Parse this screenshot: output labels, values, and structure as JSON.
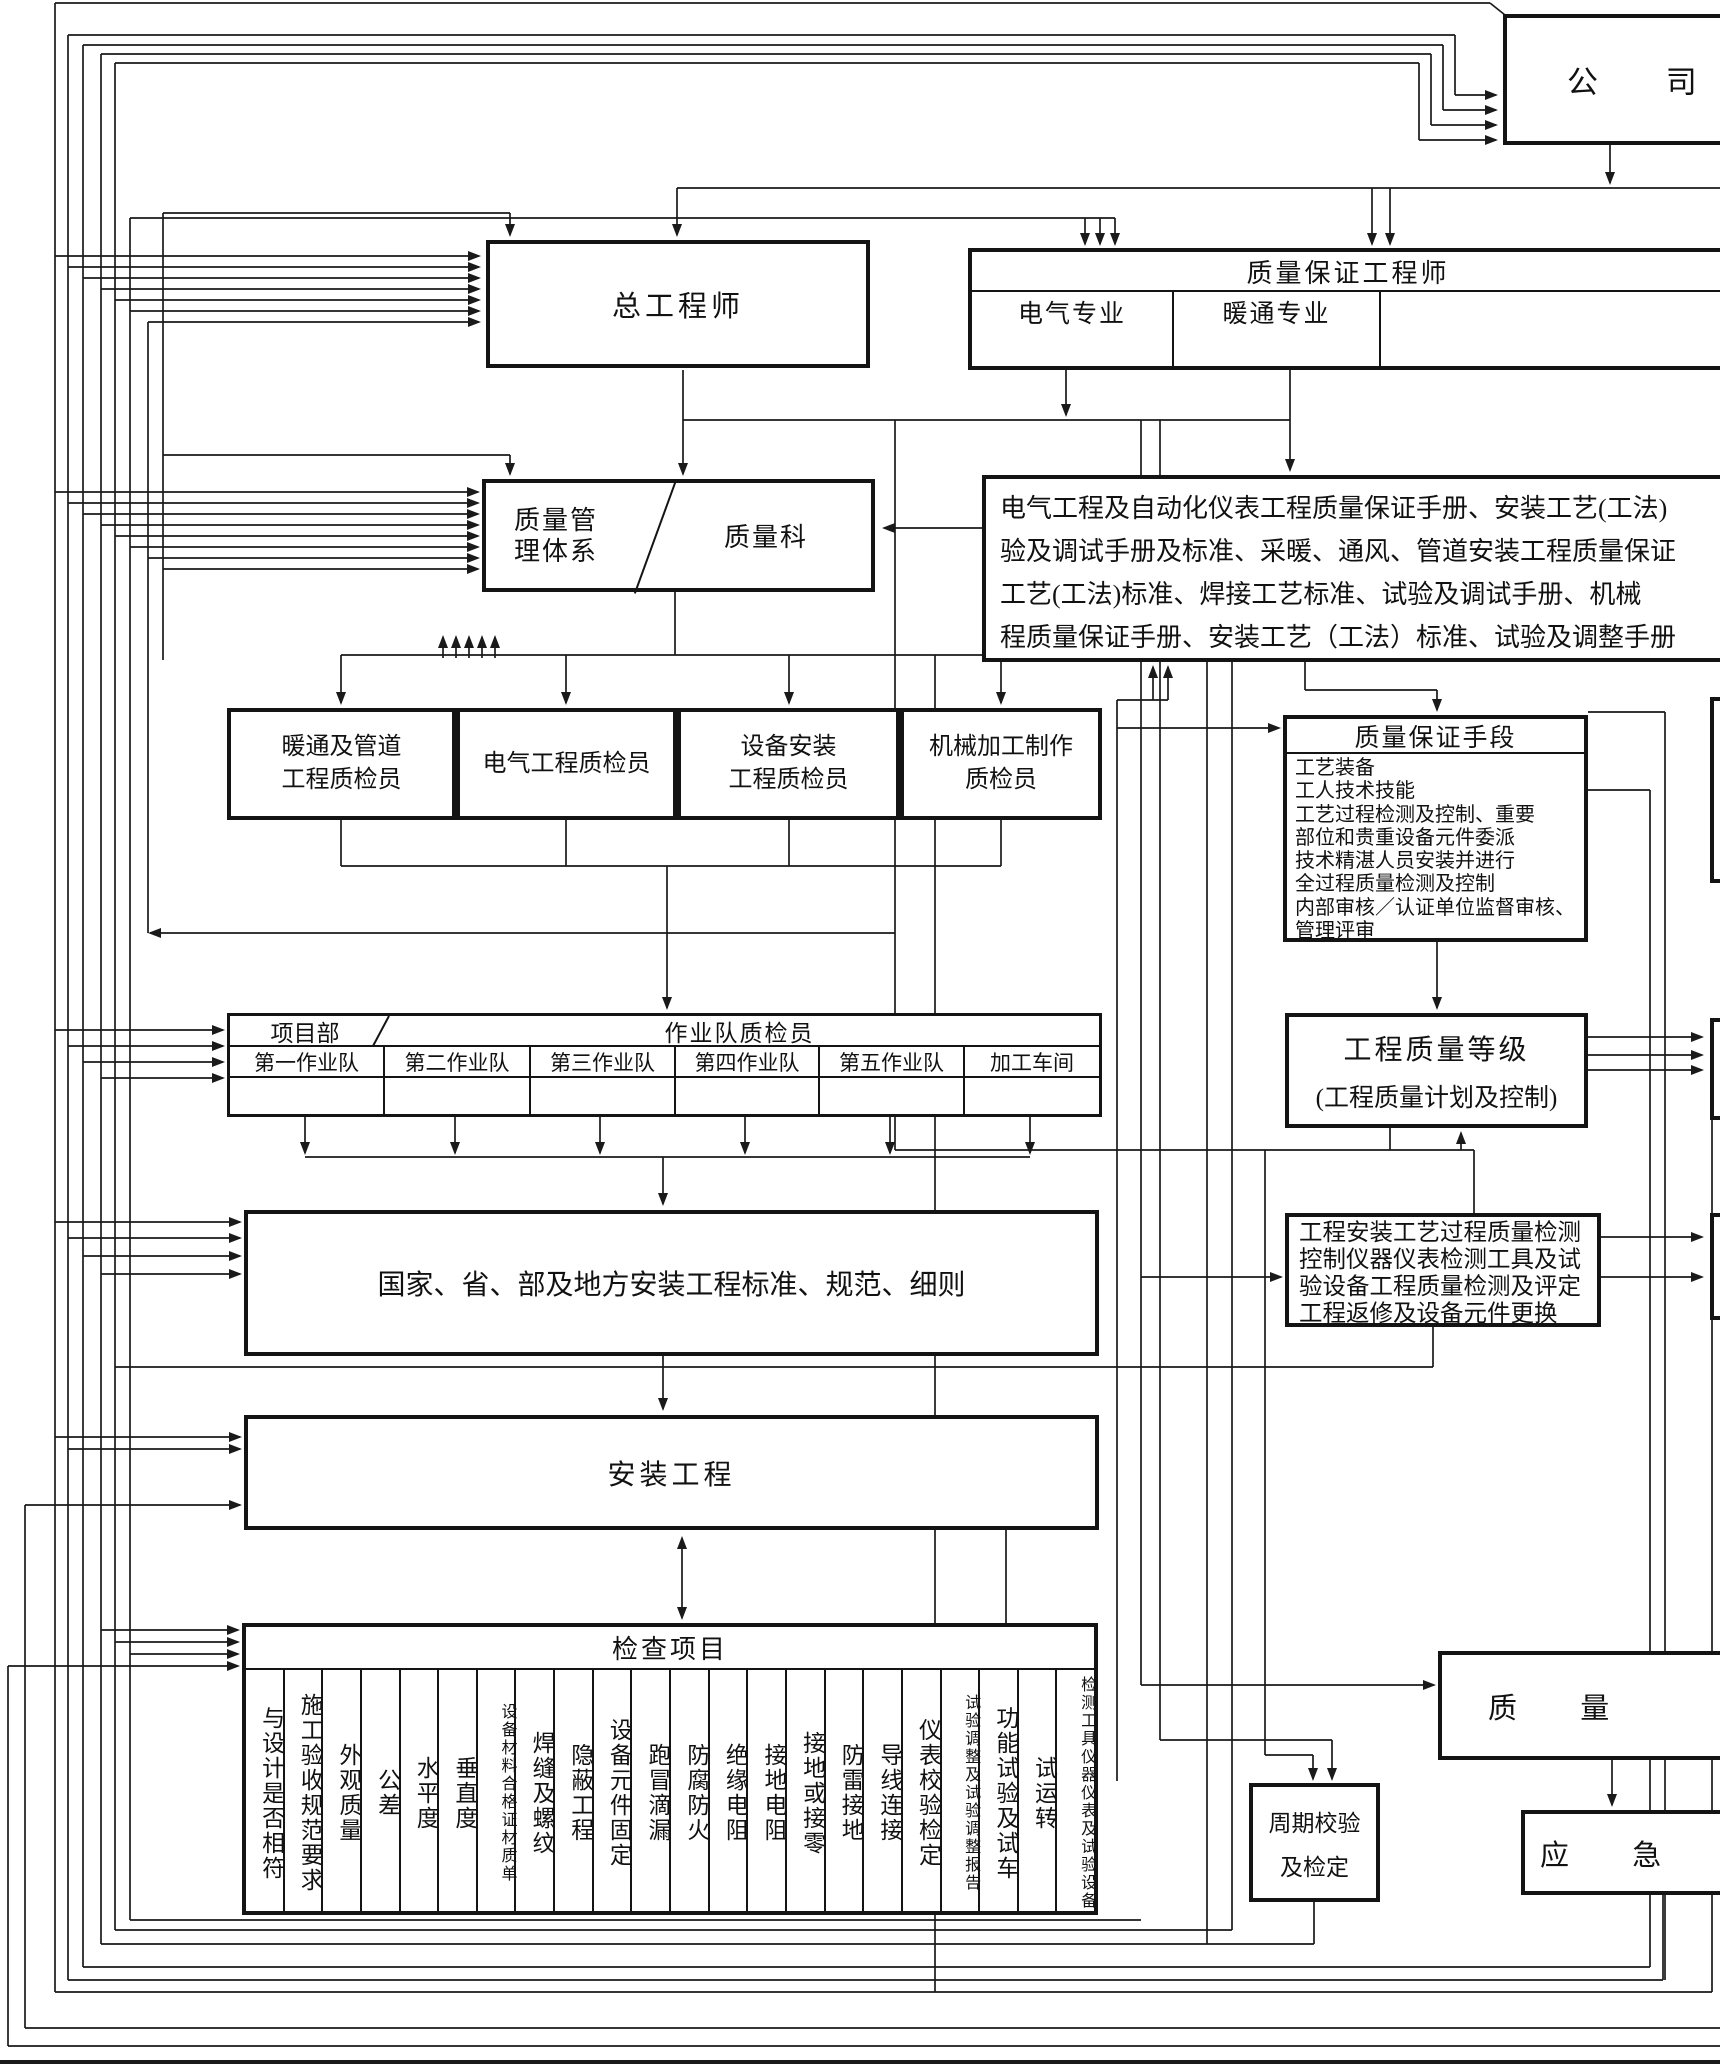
{
  "company": {
    "label": "公 司"
  },
  "chief_engineer": {
    "label": "总工程师"
  },
  "qa_engineer": {
    "title": "质量保证工程师",
    "columns": [
      "电气专业",
      "暖通专业",
      ""
    ]
  },
  "qms": {
    "line1": "质量管",
    "line2": "理体系",
    "dept": "质量科"
  },
  "manuals": {
    "lines": [
      "电气工程及自动化仪表工程质量保证手册、安装工艺(工法)",
      "验及调试手册及标准、采暖、通风、管道安装工程质量保证",
      "工艺(工法)标准、焊接工艺标准、试验及调试手册、机械",
      "程质量保证手册、安装工艺（工法）标准、试验及调整手册"
    ]
  },
  "inspectors": [
    [
      "暖通及管道",
      "工程质检员"
    ],
    [
      "电气工程质检员"
    ],
    [
      "设备安装",
      "工程质检员"
    ],
    [
      "机械加工制作",
      "质检员"
    ]
  ],
  "qa_means": {
    "title": "质量保证手段",
    "items": [
      "工艺装备",
      "工人技术技能",
      "工艺过程检测及控制、重要",
      "部位和贵重设备元件委派",
      "技术精湛人员安装并进行",
      "全过程质量检测及控制",
      "内部审核／认证单位监督审核、",
      "管理评审"
    ]
  },
  "project_dept": {
    "label": "项目部",
    "title": "作业队质检员",
    "teams": [
      "第一作业队",
      "第二作业队",
      "第三作业队",
      "第四作业队",
      "第五作业队",
      "加工车间"
    ]
  },
  "quality_grade": {
    "line1": "工程质量等级",
    "line2": "(工程质量计划及控制)"
  },
  "process_inspection": {
    "lines": [
      "工程安装工艺过程质量检测",
      "控制仪器仪表检测工具及试",
      "验设备工程质量检测及评定",
      "工程返修及设备元件更换"
    ]
  },
  "standards": {
    "label": "国家、省、部及地方安装工程标准、规范、细则"
  },
  "installation": {
    "label": "安装工程"
  },
  "check_items": {
    "title": "检查项目",
    "columns": [
      "与设计是否相符",
      "施工验收规范要求",
      "外观质量",
      "公差",
      "水平度",
      "垂直度",
      "设备材料合格证材质单",
      "焊缝及螺纹",
      "隐蔽工程",
      "设备元件固定",
      "跑冒滴漏",
      "防腐防火",
      "绝缘电阻",
      "接地电阻",
      "接地或接零",
      "防雷接地",
      "导线连接",
      "仪表校验检定",
      "试验调整及试验调整报告",
      "功能试验及试车",
      "试运转",
      "检测工具仪器仪表及试验设备"
    ]
  },
  "quality_record": {
    "label": "质 量"
  },
  "periodic_check": {
    "line1": "周期校验",
    "line2": "及检定"
  },
  "emergency": {
    "label": "应 急"
  },
  "colors": {
    "line": "#1a1a1a",
    "background": "#ffffff"
  }
}
